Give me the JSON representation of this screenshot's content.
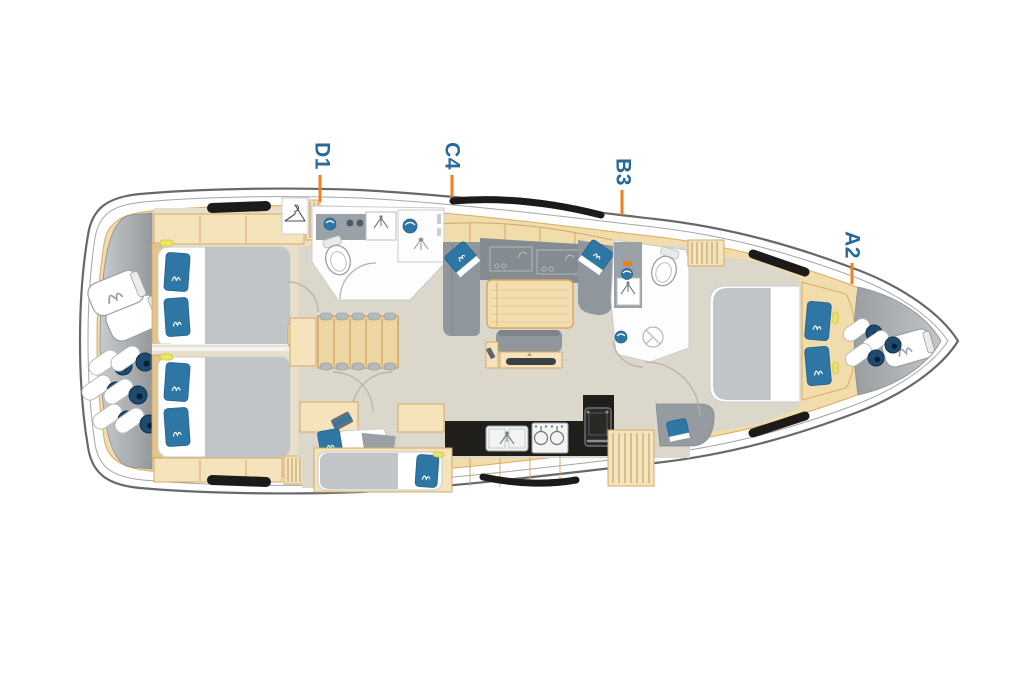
{
  "figure": {
    "type": "yacht-deck-plan",
    "orientation": "bow-right",
    "description": "Top-view interior layout plan of a sailing yacht"
  },
  "markers": [
    {
      "id": "D1",
      "text": "D1"
    },
    {
      "id": "C4",
      "text": "C4"
    },
    {
      "id": "B3",
      "text": "B3"
    },
    {
      "id": "A2",
      "text": "A2"
    }
  ],
  "colors": {
    "label_blue": "#256a9a",
    "tick_orange": "#f3801e",
    "wood": "#f1dcac",
    "wood_edge": "#dcaa62",
    "floor": "#dcd7cb",
    "furniture_gray": "#8f969c",
    "cushion_blue": "#2e77a5",
    "fender_navy": "#1d4a6e",
    "window_black": "#1d1b19",
    "hull_stroke": "#66696c"
  },
  "icons": [
    "double-berth-icon",
    "island-berth-icon",
    "single-berth-icon",
    "pillow-icon",
    "toilet-icon",
    "washbasin-icon",
    "shower-icon",
    "faucet-icon",
    "stove-icon",
    "galley-sink-icon",
    "fridge-icon",
    "sofa-icon",
    "saloon-table-icon",
    "tv-icon",
    "companionway-steps-icon",
    "wardrobe-hanger-icon",
    "fender-icon",
    "sail-bag-icon",
    "hull-window-icon"
  ]
}
